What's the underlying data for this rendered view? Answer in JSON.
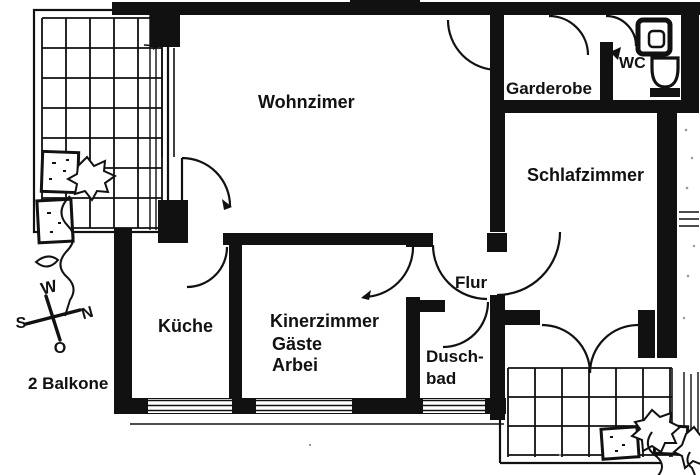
{
  "floorplan": {
    "rooms": {
      "wohnzimmer": "Wohnzimer",
      "garderobe": "Garderobe",
      "wc": "WC",
      "schlafzimmer": "Schlafzimmer",
      "kueche": "Küche",
      "kinderzimmer_line1": "Kinerzimmer",
      "kinderzimmer_line2": "Gäste",
      "kinderzimmer_line3": "Arbei",
      "flur": "Flur",
      "duschbad_line1": "Dusch-",
      "duschbad_line2": "bad"
    },
    "annotations": {
      "balconies": "2 Balkone"
    },
    "compass": {
      "west": "W",
      "north": "N",
      "south": "S",
      "east": "O"
    },
    "colors": {
      "ink": "#111111",
      "paper": "#ffffff"
    }
  }
}
